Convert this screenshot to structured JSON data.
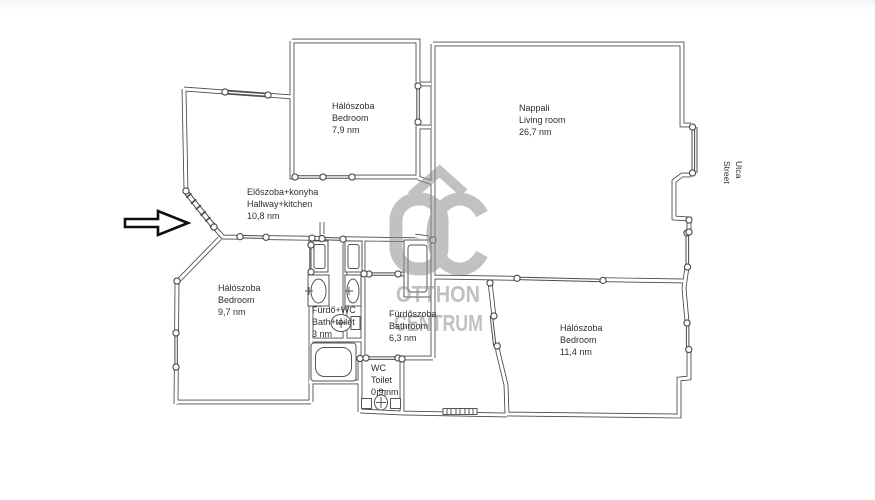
{
  "page": {
    "background": "#ffffff"
  },
  "watermark": {
    "logo": "OC",
    "line1": "OTTHON",
    "line2": "CENTRUM",
    "color": "#9a9a9a"
  },
  "street_label": {
    "line1": "Utca",
    "line2": "Street"
  },
  "entrance": {
    "symbol": "right-arrow"
  },
  "rooms": [
    {
      "id": "bedroom-top",
      "name_hu": "Hálószoba",
      "name_en": "Bedroom",
      "area": "7,9 nm"
    },
    {
      "id": "living-room",
      "name_hu": "Nappali",
      "name_en": "Living room",
      "area": "26,7 nm"
    },
    {
      "id": "hallway-kitchen",
      "name_hu": "Előszoba+konyha",
      "name_en": "Hallway+kitchen",
      "area": "10,8 nm"
    },
    {
      "id": "bedroom-left",
      "name_hu": "Hálószoba",
      "name_en": "Bedroom",
      "area": "9,7 nm"
    },
    {
      "id": "bath-toilet",
      "name_hu": "Fürdő+WC",
      "name_en": "Bath+toilet",
      "area": "3 nm"
    },
    {
      "id": "bathroom",
      "name_hu": "Fürdőszoba",
      "name_en": "Bathroom",
      "area": "6,3 nm"
    },
    {
      "id": "wc",
      "name_hu": "WC",
      "name_en": "Toilet",
      "area": "0,9 nm"
    },
    {
      "id": "bedroom-right",
      "name_hu": "Hálószoba",
      "name_en": "Bedroom",
      "area": "11,4 nm"
    }
  ]
}
